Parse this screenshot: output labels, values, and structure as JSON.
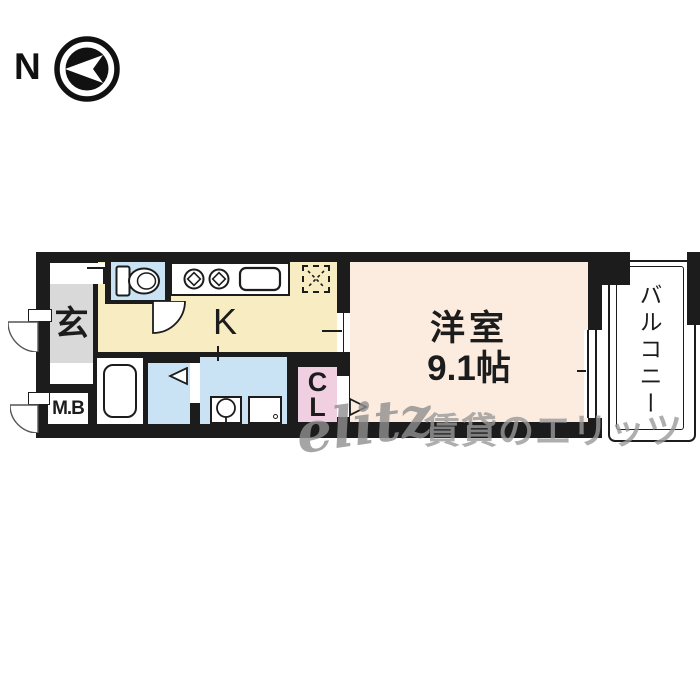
{
  "compass": {
    "label": "N",
    "icon": "north-arrow-icon"
  },
  "plan": {
    "entrance": {
      "label": "玄"
    },
    "meter_box": {
      "label": "M.B"
    },
    "kitchen": {
      "label": "K"
    },
    "western_room": {
      "name": "洋室",
      "size": "9.1帖"
    },
    "closet": {
      "letters": {
        "0": "C",
        "1": "L"
      }
    },
    "balcony": {
      "label": "バルコニー"
    }
  },
  "fixtures": [
    "toilet",
    "kitchen-stove",
    "kitchen-sink",
    "refrigerator-space",
    "bathtub",
    "washbasin",
    "washing-machine-space"
  ],
  "watermark": {
    "logo": "elitz",
    "text": "賃貸のエリッツ"
  },
  "colors": {
    "wall": "#1c1c1c",
    "kitchen_floor": "#f8ecc2",
    "water_rooms": "#c9e3f4",
    "western_room": "#fcece0",
    "closet": "#efcfe0",
    "entrance": "#d9d9d9",
    "watermark_gray": "#9a9a9a"
  }
}
